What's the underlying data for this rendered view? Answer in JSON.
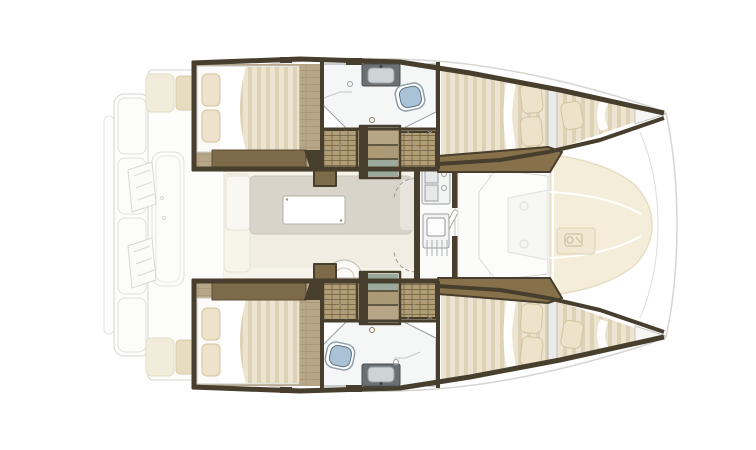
{
  "plan": {
    "label": "catamaran-interior-floor-plan-top-view-bow-right",
    "areas": [
      "aft-swim-platform",
      "aft-cockpit",
      "port-aft-cabin",
      "port-head",
      "port-companionway",
      "salon",
      "galley",
      "forward-cockpit",
      "bow-sunpads",
      "port-forward-cabin",
      "port-bow-berth",
      "starboard-aft-cabin",
      "starboard-head",
      "starboard-companionway",
      "starboard-forward-cabin",
      "starboard-bow-berth"
    ],
    "fixtures": [
      "double-bed",
      "pillow",
      "toilet",
      "sink",
      "shower-drain",
      "wardrobe-shelves",
      "companionway-stairs",
      "salon-table",
      "lounge-seat",
      "galley-stove",
      "galley-sink",
      "curved-step",
      "windlass-plate",
      "cockpit-bench",
      "helm-steps"
    ]
  },
  "colors": {
    "wall": "#473e2d",
    "wood": "#b7a688",
    "wood_line": "#a08e6d",
    "bench": "#7d6a49",
    "bench_dark": "#5c4d35",
    "gunwale": "#87714a",
    "duvet_a": "#ece3d0",
    "duvet_b": "#ddd1b6",
    "pillow": "#eee3ca",
    "pillow_line": "#d3c3a0",
    "bath_floor": "#f5f6f6",
    "bath_line": "#9aa0a3",
    "toilet": "#a9c2d6",
    "toilet_dark": "#5d7285",
    "sink_dark": "#6b7073",
    "sink_light": "#ced3d5",
    "hatch_base": "#b19e76",
    "hatch_line": "#6e5d3c",
    "teal": "#9aa99b",
    "salon_floor": "#f2ede3",
    "lounge": "#d9d4ca",
    "sofa": "#f7f4ec",
    "cushion": "#f2ecdb",
    "cushion_tan": "#e7dcc0",
    "sunpad": "#f4edda",
    "sunpad_line": "#e6ddc5",
    "deck_line": "#d5d5d2",
    "deck_fill": "#fdfdfc",
    "arc": "#9a9a98"
  }
}
